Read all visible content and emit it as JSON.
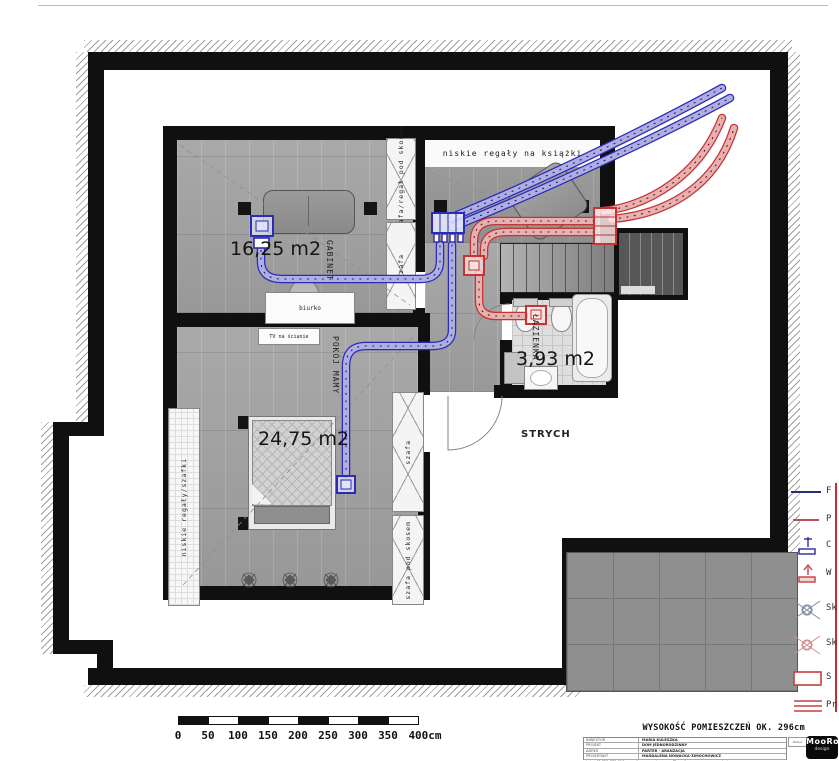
{
  "colors": {
    "supply_blue": "#2b2bb5",
    "exhaust_red": "#c33434",
    "wall": "#101010"
  },
  "plan": {
    "rooms": {
      "gabinet": {
        "name": "GABINET",
        "area": "16,25 m2"
      },
      "bedroom": {
        "name": "POKÓJ MAMY",
        "area": "24,75 m2"
      },
      "bathroom": {
        "name": "ŁAZIENKA",
        "area": "3,93 m2"
      },
      "attic": {
        "name": "STRYCH"
      }
    },
    "furniture": {
      "bookshelf_top": "niskie regały na książki",
      "wardrobe_slope_office": "szafa/regał pod skosem",
      "wardrobe_office": "szafa",
      "desk": "biurko",
      "tv": "TV na ścianie",
      "shelves_bedroom": "niskie regały/szafki",
      "wardrobe_bedroom": "szafa",
      "wardrobe_slope_bedroom": "szafa pod skosem"
    }
  },
  "legend": {
    "items": [
      {
        "label": "F"
      },
      {
        "label": "P"
      },
      {
        "label": "C"
      },
      {
        "label": "W"
      },
      {
        "label": "Sk"
      },
      {
        "label": "Sk"
      },
      {
        "label": "S"
      },
      {
        "label": "Pr"
      }
    ]
  },
  "scalebar": {
    "labels": [
      "0",
      "50",
      "100",
      "150",
      "200",
      "250",
      "300",
      "350",
      "400cm"
    ]
  },
  "titleblock": {
    "height_note": "WYSOKOŚĆ POMIESZCZEŃ OK. 296cm",
    "rows": [
      {
        "label": "INWESTOR",
        "value": "MARIA KULESZKA"
      },
      {
        "label": "PROJEKT",
        "value": "DOM JEDNORODZINNY"
      },
      {
        "label": "ADRES",
        "value": "PARTER - ARANŻACJA"
      },
      {
        "label": "PROJEKTANT",
        "value": "MAGDALENA NOWACKA-ZIMOCHOWICZ"
      }
    ],
    "contact": "tel. +48 725 775 610, e-mail: pracowniamooroo@gmail.com, www.mooroodesign.com",
    "scale_label": "SKALA",
    "logo_top": "MooRoo",
    "logo_bottom": "design"
  }
}
